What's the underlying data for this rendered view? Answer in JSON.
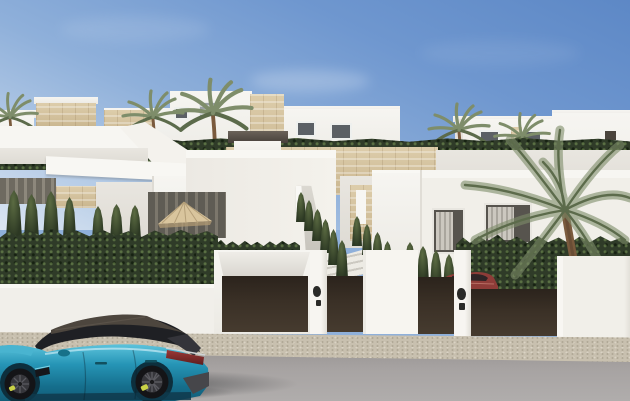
{
  "scene": {
    "description": "Sunny render of new-build white Mediterranean villas on a hillside behind a white street wall with dark brown gates and a garage door; cypress hedges, palm trees, a patio parasol, a dark-red car inside a driveway and a teal estate car parked on the grey road.",
    "time_of_day": "daytime, clear blue sky"
  },
  "palette": {
    "sky_top": "#5d88c6",
    "sky_mid": "#8fb0da",
    "sky_horizon": "#dce6f2",
    "wall_white": "#f5f3ef",
    "wall_shade": "#e4e1da",
    "stone_beige": "#d7c6a4",
    "hedge_dark": "#2f3b28",
    "hedge_mid": "#4b593c",
    "palm_green": "#7e8d6a",
    "palm_dark": "#5c6b4b",
    "trunk_brown": "#7a5a3d",
    "gate_brown": "#3a3026",
    "sidewalk_beige": "#c8c0af",
    "road_grey": "#a7a3a2",
    "car_teal": "#2695b6",
    "car_teal_dark": "#156e8c",
    "car_roof_grey": "#4d463e",
    "glass_dark": "#1f2024",
    "taillight_red": "#8b3231",
    "brake_caliper_yellow": "#c9d247",
    "red_car": "#8e3c38"
  },
  "objects": [
    {
      "name": "sky",
      "label": "clear blue sky"
    },
    {
      "name": "background-villas",
      "label": "upper terrace white villas with stone cladding"
    },
    {
      "name": "palm-trees",
      "label": "palm trees"
    },
    {
      "name": "upper-hedge",
      "label": "terrace hedge row"
    },
    {
      "name": "stone-retaining-wall",
      "label": "travertine retaining wall"
    },
    {
      "name": "villa-left",
      "label": "left villa with angled roof slabs"
    },
    {
      "name": "villa-center",
      "label": "center villa with chimney and covered patio"
    },
    {
      "name": "patio-parasol",
      "label": "tan patio parasol"
    },
    {
      "name": "walkway-steps",
      "label": "stepped walkway between hedges"
    },
    {
      "name": "villa-right",
      "label": "right villa with curtained windows"
    },
    {
      "name": "big-palm",
      "label": "large palm in right garden"
    },
    {
      "name": "red-suv",
      "label": "dark red car inside driveway"
    },
    {
      "name": "boundary-wall",
      "label": "white street wall"
    },
    {
      "name": "garage-door",
      "label": "dark brown garage door"
    },
    {
      "name": "driveway-gates",
      "label": "dark brown sliding gates"
    },
    {
      "name": "intercom-pillars",
      "label": "white pillars with intercom plaques"
    },
    {
      "name": "sidewalk",
      "label": "beige gravel sidewalk"
    },
    {
      "name": "road",
      "label": "grey asphalt road"
    },
    {
      "name": "teal-estate-car",
      "label": "teal estate car parked on road"
    }
  ]
}
